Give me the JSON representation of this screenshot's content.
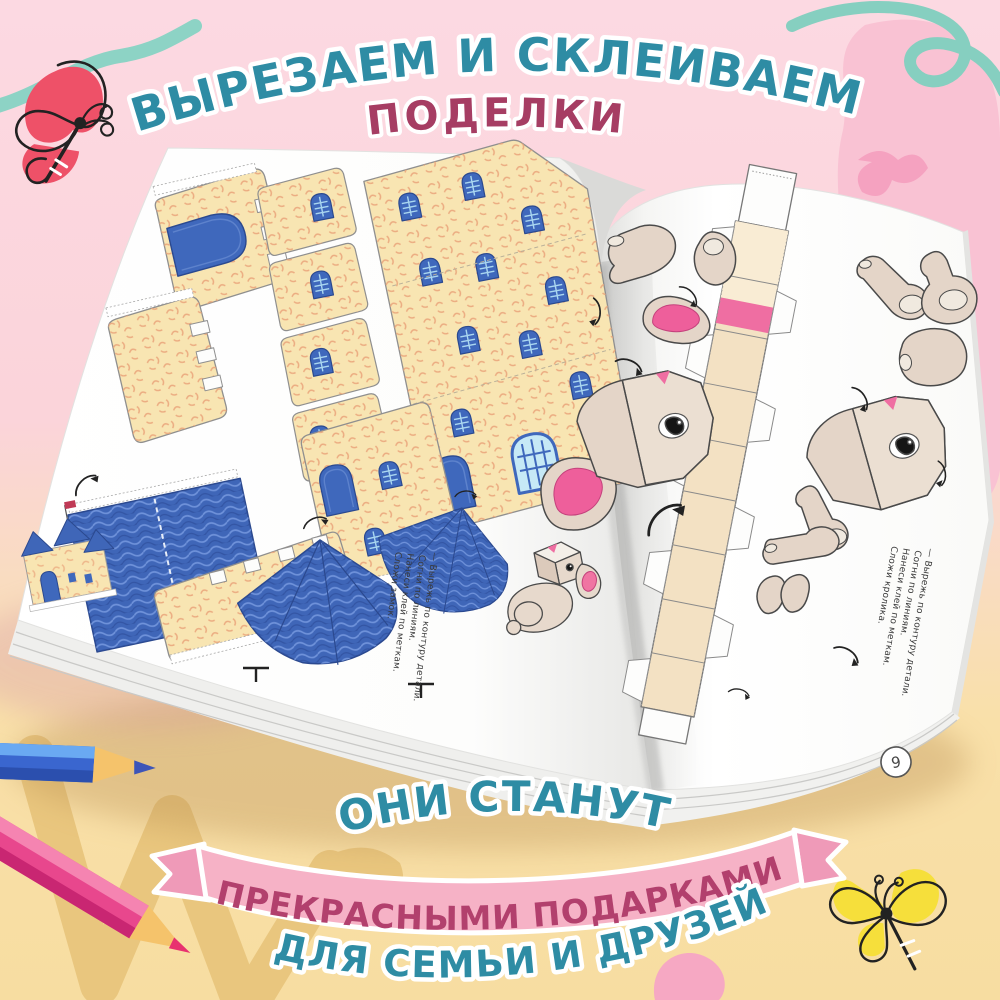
{
  "page": {
    "width": 1000,
    "height": 1000
  },
  "title": {
    "line1": "ВЫРЕЗАЕМ И СКЛЕИВАЕМ",
    "line2": "ПОДЕЛКИ"
  },
  "footer": {
    "line1": "ОНИ СТАНУТ",
    "banner": "ПРЕКРАСНЫМИ ПОДАРКАМИ",
    "line2": "ДЛЯ СЕМЬИ И ДРУЗЕЙ"
  },
  "book": {
    "left_page": {
      "subject": "castle papercraft cut-out sheet",
      "instructions": [
        "— Вырежь по контуру детали.",
        "Согни по линиям.",
        "Нанеси клей по меткам.",
        "Сложи замок."
      ]
    },
    "right_page": {
      "subject": "rabbit papercraft cut-out sheet",
      "page_number": "9",
      "instructions": [
        "— Вырежь по контуру детали.",
        "Согни по линиям.",
        "Нанеси клей по меткам.",
        "Сложи кролика."
      ]
    }
  },
  "decorations": {
    "top_left": "red-butterfly-icon",
    "bottom_right": "yellow-butterfly-icon",
    "bottom_left": [
      "blue-pencil-icon",
      "pink-pencil-icon"
    ],
    "brush_strokes": [
      "teal-wavy-stroke",
      "teal-loop-scribble",
      "pink-blob",
      "tan-zigzag-stroke"
    ]
  },
  "colors": {
    "teal_text": "#2e8ca4",
    "maroon_text": "#a63d63",
    "banner_pink": "#f6b2c6",
    "banner_text": "#b2406d",
    "bg_pink": "#fbd7e0",
    "bg_yellow": "#f8dfa4",
    "castle_yellow": "#f8e5b2",
    "castle_blue": "#3f66b8",
    "rabbit_beige": "#e4d5c8",
    "ear_pink": "#ee5f9b"
  }
}
